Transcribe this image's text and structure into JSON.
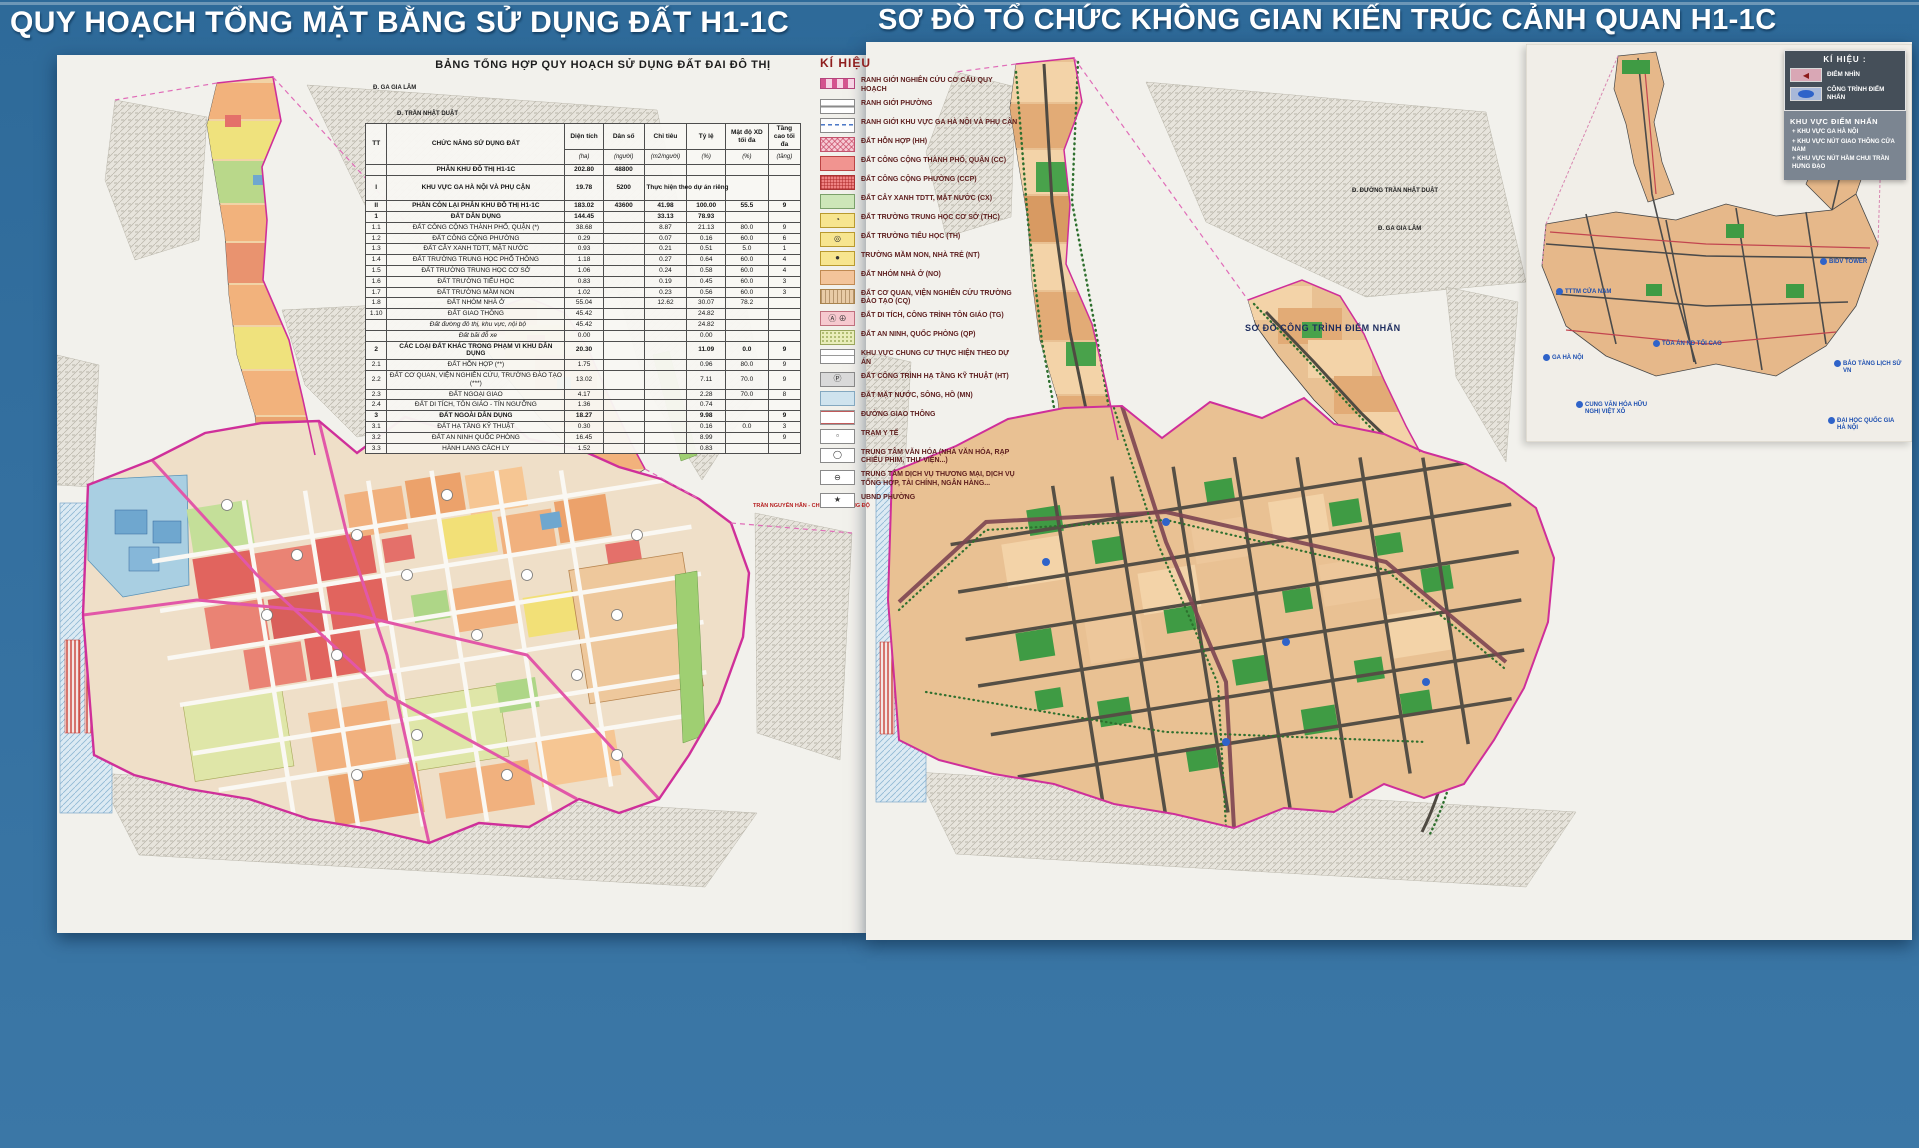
{
  "left_panel": {
    "title": "QUY HOẠCH TỔNG MẶT BẰNG SỬ DỤNG ĐẤT H1-1C",
    "table": {
      "title": "BẢNG TỔNG HỢP QUY HOẠCH SỬ DỤNG ĐẤT ĐAI ĐÔ THỊ",
      "col_tt": "TT",
      "col_name": "CHỨC NĂNG SỬ DỤNG ĐẤT",
      "cols": [
        "Diện tích",
        "Dân số",
        "Chỉ tiêu",
        "Tỷ lệ",
        "Mật độ XD tối đa",
        "Tầng cao tối đa"
      ],
      "units": [
        "(ha)",
        "(người)",
        "(m2/người)",
        "(%)",
        "(%)",
        "(tầng)"
      ],
      "rows": [
        {
          "tt": "",
          "name": "PHÂN KHU ĐÔ THỊ H1-1C",
          "c": [
            "202.80",
            "48800",
            "",
            "",
            "",
            ""
          ],
          "cls": "b"
        },
        {
          "tt": "I",
          "name": "KHU VỰC GA HÀ NỘI VÀ PHỤ CẬN",
          "c": [
            "19.78",
            "5200",
            "Thực hiện theo dự án riêng",
            "",
            "",
            ""
          ],
          "cls": "b tall note"
        },
        {
          "tt": "II",
          "name": "PHẦN CÒN LẠI PHÂN KHU ĐÔ THỊ H1-1C",
          "c": [
            "183.02",
            "43600",
            "41.98",
            "100.00",
            "55.5",
            "9"
          ],
          "cls": "b"
        },
        {
          "tt": "1",
          "name": "ĐẤT DÂN DỤNG",
          "c": [
            "144.45",
            "",
            "33.13",
            "78.93",
            "",
            ""
          ],
          "cls": "b"
        },
        {
          "tt": "1.1",
          "name": "ĐẤT CÔNG CỘNG THÀNH PHỐ, QUẬN (*)",
          "c": [
            "38.68",
            "",
            "8.87",
            "21.13",
            "80.0",
            "9"
          ],
          "cls": ""
        },
        {
          "tt": "1.2",
          "name": "ĐẤT CÔNG CỘNG PHƯỜNG",
          "c": [
            "0.29",
            "",
            "0.07",
            "0.16",
            "60.0",
            "6"
          ],
          "cls": ""
        },
        {
          "tt": "1.3",
          "name": "ĐẤT CÂY XANH TDTT, MẶT NƯỚC",
          "c": [
            "0.93",
            "",
            "0.21",
            "0.51",
            "5.0",
            "1"
          ],
          "cls": ""
        },
        {
          "tt": "1.4",
          "name": "ĐẤT TRƯỜNG TRUNG HỌC PHỔ THÔNG",
          "c": [
            "1.18",
            "",
            "0.27",
            "0.64",
            "60.0",
            "4"
          ],
          "cls": ""
        },
        {
          "tt": "1.5",
          "name": "ĐẤT TRƯỜNG TRUNG HỌC CƠ SỞ",
          "c": [
            "1.06",
            "",
            "0.24",
            "0.58",
            "60.0",
            "4"
          ],
          "cls": ""
        },
        {
          "tt": "1.6",
          "name": "ĐẤT TRƯỜNG TIỂU HỌC",
          "c": [
            "0.83",
            "",
            "0.19",
            "0.45",
            "60.0",
            "3"
          ],
          "cls": ""
        },
        {
          "tt": "1.7",
          "name": "ĐẤT TRƯỜNG MẦM NON",
          "c": [
            "1.02",
            "",
            "0.23",
            "0.56",
            "60.0",
            "3"
          ],
          "cls": ""
        },
        {
          "tt": "1.8",
          "name": "ĐẤT NHÓM NHÀ Ở",
          "c": [
            "55.04",
            "",
            "12.62",
            "30.07",
            "78.2",
            ""
          ],
          "cls": ""
        },
        {
          "tt": "1.10",
          "name": "ĐẤT GIAO THÔNG",
          "c": [
            "45.42",
            "",
            "",
            "24.82",
            "",
            ""
          ],
          "cls": ""
        },
        {
          "tt": "",
          "name": "Đất đường đô thị, khu vực, nội bộ",
          "c": [
            "45.42",
            "",
            "",
            "24.82",
            "",
            ""
          ],
          "cls": "i"
        },
        {
          "tt": "",
          "name": "Đất bãi đỗ xe",
          "c": [
            "0.00",
            "",
            "",
            "0.00",
            "",
            ""
          ],
          "cls": "i"
        },
        {
          "tt": "2",
          "name": "CÁC LOẠI ĐẤT KHÁC TRONG PHẠM VI KHU DÂN DỤNG",
          "c": [
            "20.30",
            "",
            "",
            "11.09",
            "0.0",
            "9"
          ],
          "cls": "b"
        },
        {
          "tt": "2.1",
          "name": "ĐẤT HỖN HỢP (**)",
          "c": [
            "1.75",
            "",
            "",
            "0.96",
            "80.0",
            "9"
          ],
          "cls": ""
        },
        {
          "tt": "2.2",
          "name": "ĐẤT CƠ QUAN, VIỆN NGHIÊN CỨU, TRƯỜNG ĐÀO TẠO (***)",
          "c": [
            "13.02",
            "",
            "",
            "7.11",
            "70.0",
            "9"
          ],
          "cls": ""
        },
        {
          "tt": "2.3",
          "name": "ĐẤT NGOẠI GIAO",
          "c": [
            "4.17",
            "",
            "",
            "2.28",
            "70.0",
            "8"
          ],
          "cls": ""
        },
        {
          "tt": "2.4",
          "name": "ĐẤT DI TÍCH, TÔN GIÁO - TÍN NGƯỠNG",
          "c": [
            "1.36",
            "",
            "",
            "0.74",
            "",
            ""
          ],
          "cls": ""
        },
        {
          "tt": "3",
          "name": "ĐẤT NGOÀI DÂN DỤNG",
          "c": [
            "18.27",
            "",
            "",
            "9.98",
            "",
            "9"
          ],
          "cls": "b"
        },
        {
          "tt": "3.1",
          "name": "ĐẤT HẠ TẦNG KỸ THUẬT",
          "c": [
            "0.30",
            "",
            "",
            "0.16",
            "0.0",
            "3"
          ],
          "cls": ""
        },
        {
          "tt": "3.2",
          "name": "ĐẤT AN NINH QUỐC PHÒNG",
          "c": [
            "16.45",
            "",
            "",
            "8.99",
            "",
            "9"
          ],
          "cls": ""
        },
        {
          "tt": "3.3",
          "name": "HÀNH LANG CÁCH LY",
          "c": [
            "1.52",
            "",
            "",
            "0.83",
            "",
            ""
          ],
          "cls": ""
        }
      ]
    },
    "legend": {
      "title": "KÍ HIỆU",
      "items": [
        {
          "cls": "sw-boundary",
          "label": "RANH GIỚI NGHIÊN CỨU CƠ CẤU QUY HOẠCH"
        },
        {
          "cls": "sw-ward",
          "label": "RANH GIỚI PHƯỜNG"
        },
        {
          "cls": "sw-station",
          "label": "RANH GIỚI KHU VỰC GA HÀ NỘI VÀ PHỤ CẬN"
        },
        {
          "cls": "sw-hh",
          "label": "ĐẤT HỖN HỢP (HH)"
        },
        {
          "cls": "sw-cc",
          "label": "ĐẤT CÔNG CỘNG THÀNH PHỐ, QUẬN (CC)"
        },
        {
          "cls": "sw-ccp",
          "label": "ĐẤT CÔNG CỘNG PHƯỜNG (CCP)"
        },
        {
          "cls": "sw-cx",
          "label": "ĐẤT CÂY XANH TDTT, MẶT NƯỚC (CX)"
        },
        {
          "cls": "sw-thc",
          "icon": "◔",
          "label": "ĐẤT TRƯỜNG TRUNG HỌC CƠ SỞ (THC)"
        },
        {
          "cls": "sw-th",
          "icon": "◎",
          "label": "ĐẤT TRƯỜNG TIỂU HỌC (TH)"
        },
        {
          "cls": "sw-nt",
          "icon": "●",
          "label": "TRƯỜNG MẦM NON, NHÀ TRẺ (NT)"
        },
        {
          "cls": "sw-no",
          "label": "ĐẤT NHÓM NHÀ Ở (NO)"
        },
        {
          "cls": "sw-cq",
          "label": "ĐẤT CƠ QUAN, VIỆN NGHIÊN CỨU TRƯỜNG ĐÀO TẠO (CQ)"
        },
        {
          "cls": "sw-tg",
          "icon": "Ⓐ ⊕",
          "label": "ĐẤT DI TÍCH, CÔNG TRÌNH TÔN GIÁO (TG)"
        },
        {
          "cls": "sw-qp",
          "label": "ĐẤT AN NINH, QUỐC PHÒNG (QP)"
        },
        {
          "cls": "sw-cc2",
          "label": "KHU VỰC CHUNG CƯ THỰC HIỆN THEO DỰ ÁN"
        },
        {
          "cls": "sw-ht",
          "icon": "Ⓟ",
          "label": "ĐẤT CÔNG TRÌNH HẠ TẦNG KỸ THUẬT (HT)"
        },
        {
          "cls": "sw-mn",
          "label": "ĐẤT MẶT NƯỚC, SÔNG, HỒ (MN)"
        },
        {
          "cls": "sw-road",
          "label": "ĐƯỜNG GIAO THÔNG"
        },
        {
          "cls": "sw-yte",
          "icon": "▫",
          "label": "TRẠM Y TẾ"
        },
        {
          "cls": "sw-vanhoa",
          "icon": "◯",
          "label": "TRUNG TÂM VĂN HÓA (NHÀ VĂN HÓA, RẠP CHIẾU PHIM, THƯ VIỆN...)"
        },
        {
          "cls": "sw-dichvu",
          "icon": "⊖",
          "label": "TRUNG TÂM DỊCH VỤ THƯƠNG MẠI, DỊCH VỤ TỔNG HỢP, TÀI CHÍNH, NGÂN HÀNG..."
        },
        {
          "cls": "sw-ubnd",
          "icon": "★",
          "label": "UBND PHƯỜNG"
        }
      ]
    },
    "map_labels": [
      "Đ. GA GIA LÂM",
      "Đ. TRẦN NHẬT DUẬT",
      "TRẦN NGUYÊN HÃN - CHƯƠNG DƯƠNG ĐỘ"
    ]
  },
  "right_panel": {
    "title": "SƠ ĐỒ TỔ CHỨC KHÔNG GIAN KIẾN TRÚC CẢNH QUAN H1-1C",
    "legend": {
      "title": "KÍ HIỆU :",
      "items": [
        {
          "cls": "sw-viewpoint",
          "icon": "◀",
          "label": "ĐIỂM NHÌN"
        },
        {
          "cls": "sw-landmark",
          "icon": "",
          "label": "CÔNG TRÌNH ĐIỂM NHẤN"
        }
      ],
      "area_title": "KHU VỰC ĐIỂM NHẤN",
      "areas": [
        "KHU VỰC GA HÀ NỘI",
        "KHU VỰC NÚT GIAO THÔNG CỬA NAM",
        "KHU VỰC NÚT HẦM CHUI TRẦN HƯNG ĐẠO"
      ]
    },
    "inset_caption": "SƠ ĐỒ CÔNG TRÌNH ĐIỂM NHẤN",
    "landmarks": [
      "TTTM CỬA NAM",
      "GA HÀ NỘI",
      "TÒA ÁN ND TỐI CAO",
      "BIDV TOWER",
      "BẢO TÀNG LỊCH SỬ VN",
      "CUNG VĂN HÓA HỮU NGHỊ VIỆT XÔ",
      "ĐẠI HỌC QUỐC GIA HÀ NỘI"
    ],
    "map_labels": [
      "Đ. ĐƯỜNG TRẦN NHẬT DUẬT",
      "Đ. GA GIA LÂM"
    ]
  }
}
